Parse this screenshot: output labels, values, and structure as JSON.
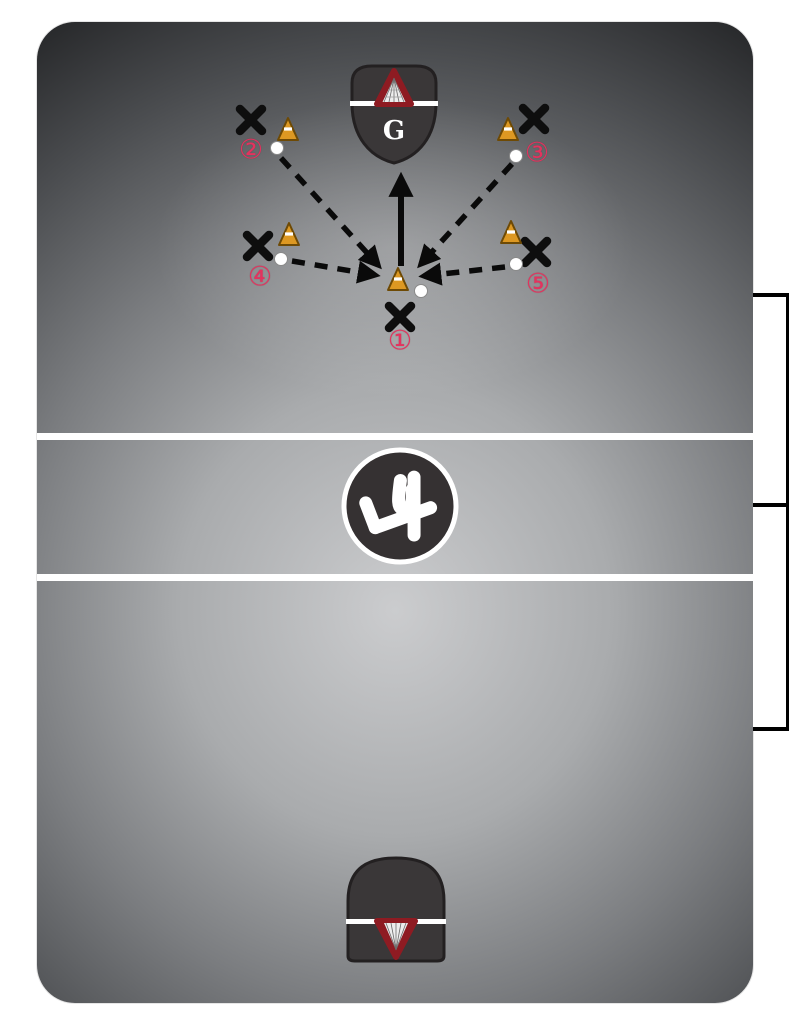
{
  "page": {
    "background": "#ffffff"
  },
  "field": {
    "surface_center_color": "#cbccce",
    "surface_edge_color": "#232426",
    "line_color": "#ffffff",
    "horizontal_line_count": 2
  },
  "goals": {
    "top": {
      "label": "G",
      "crease_color": "#3a3738",
      "net_color": "#8e1b22",
      "line_color": "#ffffff"
    },
    "bottom": {
      "crease_color": "#3a3738",
      "net_color": "#8e1b22",
      "line_color": "#ffffff"
    }
  },
  "center_circle": {
    "disc_color": "#353132",
    "ring_color": "#ffffff",
    "logo": "l4-logo"
  },
  "players": [
    {
      "label": "①"
    },
    {
      "label": "②"
    },
    {
      "label": "③"
    },
    {
      "label": "④"
    },
    {
      "label": "⑤"
    }
  ],
  "markers": {
    "x_color": "#0e0e0e",
    "cone_color": "#dd9822",
    "ball_color": "#ffffff",
    "number_color": "#e5325e",
    "arrow_color": "#0a0a0a",
    "pass_arrow_count": 4,
    "shot_arrow_count": 1
  },
  "bench_boxes": {
    "fill": "#ffffff",
    "border": "#000000",
    "count": 2
  }
}
